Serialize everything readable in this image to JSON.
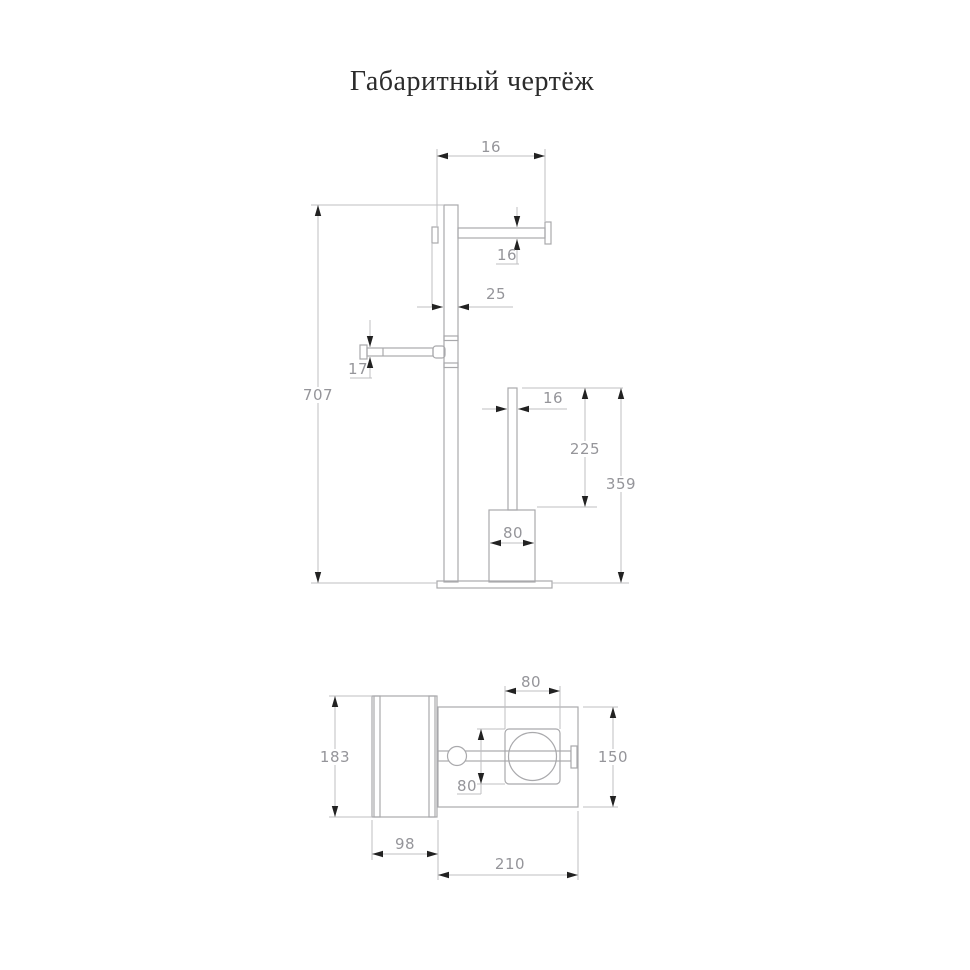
{
  "title": "Габаритный чертёж",
  "front_view": {
    "dims": {
      "arm_length_top": "16",
      "arm_diameter": "16",
      "pole_width": "25",
      "left_arm_diameter": "17",
      "total_height": "707",
      "brush_handle_diameter": "16",
      "brush_handle_height": "225",
      "brush_total_height": "359",
      "cup_width": "80"
    }
  },
  "plan_view": {
    "dims": {
      "roll_depth": "183",
      "roll_width": "98",
      "base_length": "210",
      "base_depth": "150",
      "cup_top_width": "80",
      "cup_top_depth": "80"
    }
  }
}
